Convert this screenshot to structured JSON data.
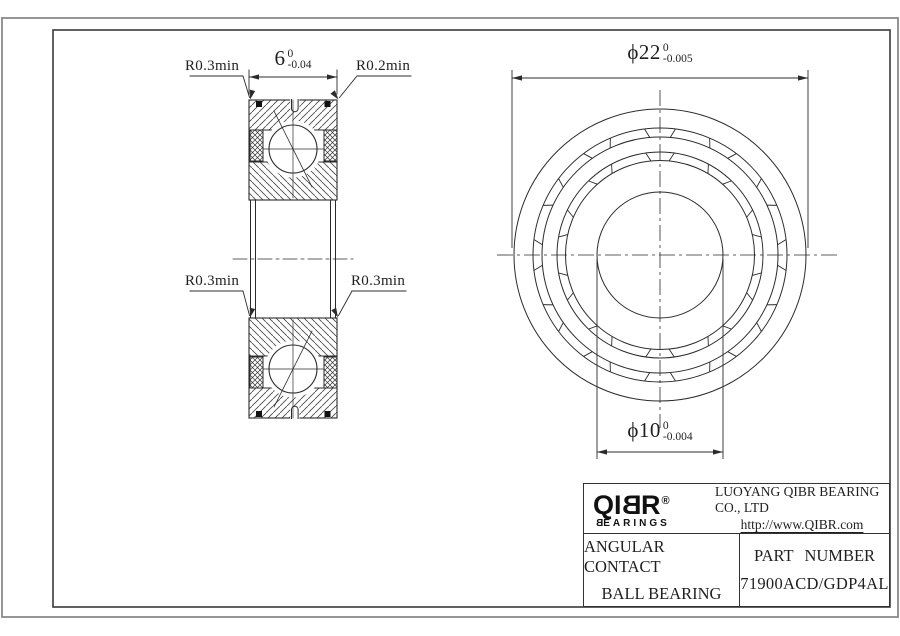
{
  "drawing": {
    "section_view": {
      "dim_width": {
        "value": "6",
        "tol_upper": "0",
        "tol_lower": "-0.04"
      },
      "radius_top_left": "R0.3min",
      "radius_top_right": "R0.2min",
      "radius_mid_left": "R0.3min",
      "radius_mid_right": "R0.3min"
    },
    "front_view": {
      "dim_outer_diameter": {
        "value": "ϕ22",
        "tol_upper": "0",
        "tol_lower": "-0.005"
      },
      "dim_bore_diameter": {
        "value": "ϕ10",
        "tol_upper": "0",
        "tol_lower": "-0.004"
      }
    }
  },
  "title_block": {
    "logo": {
      "part1": "QI",
      "part2": "B",
      "part3": "R",
      "registered": "®",
      "sub_part1": "B",
      "sub_part2": "EARINGS"
    },
    "company": "LUOYANG QIBR BEARING CO., LTD",
    "website": "http://www.QIBR.com",
    "product_line1": "ANGULAR CONTACT",
    "product_line2": "BALL BEARING",
    "part_number_label": "PART NUMBER",
    "part_number": "71900ACD/GDP4AL"
  },
  "colors": {
    "line": "#2b2b2b",
    "frame_outer": "#8a8a8a",
    "frame_inner": "#3a3a3a",
    "background": "#ffffff"
  }
}
